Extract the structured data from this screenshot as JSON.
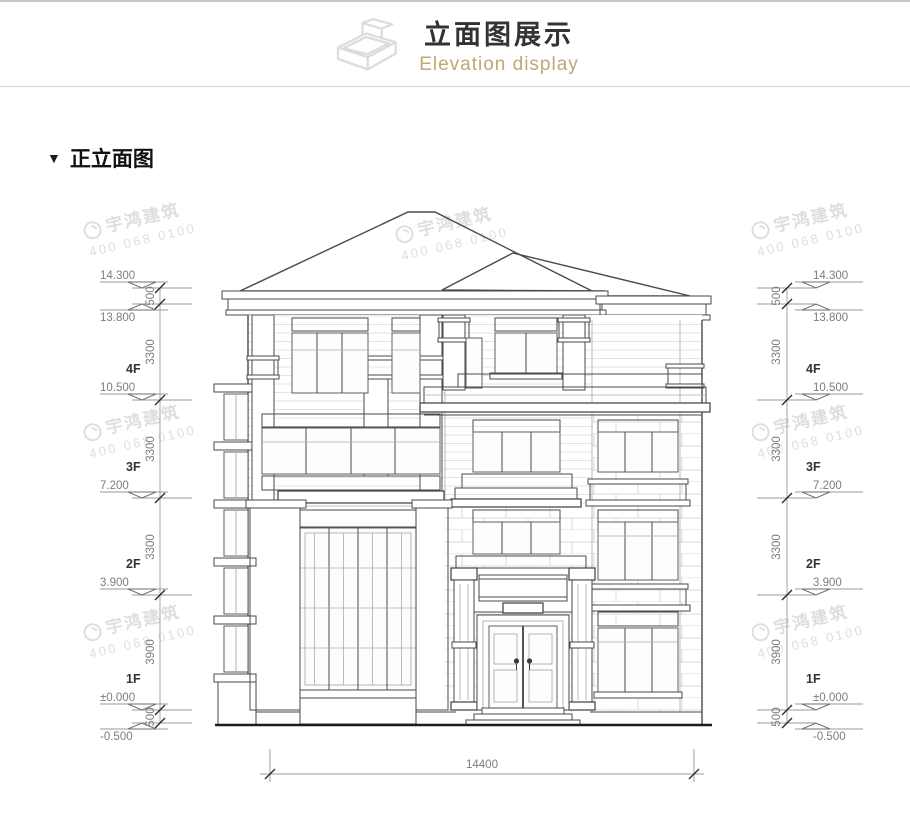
{
  "header": {
    "title": "立面图展示",
    "subtitle": "Elevation display",
    "subtitle_color": "#bfa876",
    "icon": "isometric-box-icon"
  },
  "section": {
    "marker": "▼",
    "title": "正立面图"
  },
  "watermark": {
    "brand": "宇鸿建筑",
    "phone": "400 068 0100"
  },
  "dims": {
    "levels": [
      {
        "v": "14.300"
      },
      {
        "v": "13.800"
      },
      {
        "v": "10.500"
      },
      {
        "v": "7.200"
      },
      {
        "v": "3.900"
      },
      {
        "v": "±0.000"
      },
      {
        "v": "-0.500"
      }
    ],
    "spans": [
      {
        "v": "500"
      },
      {
        "v": "3300"
      },
      {
        "v": "3300"
      },
      {
        "v": "3300"
      },
      {
        "v": "3900"
      },
      {
        "v": "500"
      }
    ],
    "floors": [
      {
        "v": "4F"
      },
      {
        "v": "3F"
      },
      {
        "v": "2F"
      },
      {
        "v": "1F"
      }
    ],
    "overall_width": "14400"
  },
  "drawing": {
    "type": "front-elevation",
    "line_color": "#4a4a4a",
    "dim_text_color": "#7d7d7d"
  }
}
